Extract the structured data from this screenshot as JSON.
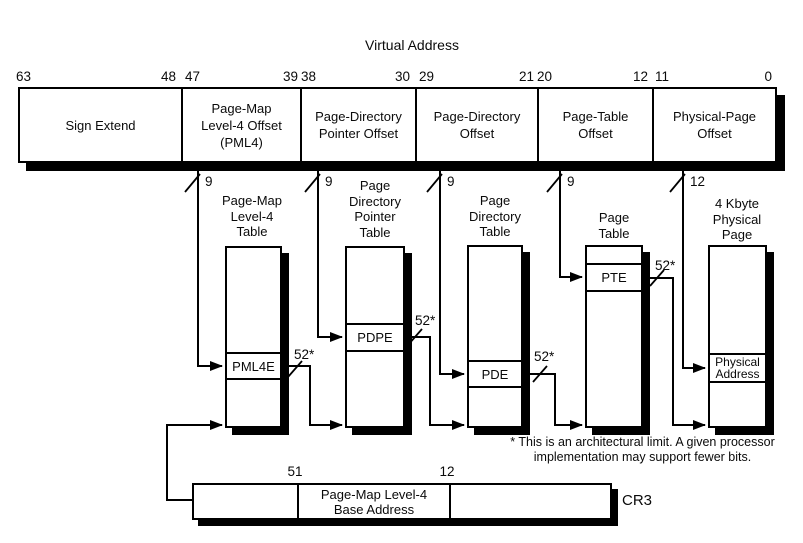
{
  "title": "Virtual Address",
  "va": {
    "bits": [
      "63",
      "48",
      "47",
      "39",
      "38",
      "30",
      "29",
      "21",
      "20",
      "12",
      "11",
      "0"
    ],
    "fields": [
      "Sign Extend",
      "Page-Map\nLevel-4 Offset\n(PML4)",
      "Page-Directory\nPointer Offset",
      "Page-Directory\nOffset",
      "Page-Table\nOffset",
      "Physical-Page\nOffset"
    ]
  },
  "widths": {
    "drops": [
      "9",
      "9",
      "9",
      "9",
      "12"
    ],
    "out": "52*"
  },
  "tables": [
    {
      "title": "Page-Map\nLevel-4\nTable",
      "entry": "PML4E"
    },
    {
      "title": "Page\nDirectory\nPointer\nTable",
      "entry": "PDPE"
    },
    {
      "title": "Page\nDirectory\nTable",
      "entry": "PDE"
    },
    {
      "title": "Page\nTable",
      "entry": "PTE"
    },
    {
      "title": "4 Kbyte\nPhysical\nPage",
      "entry": "Physical\nAddress"
    }
  ],
  "cr3": {
    "bits": [
      "51",
      "12"
    ],
    "field": "Page-Map Level-4\nBase Address",
    "label": "CR3"
  },
  "footnote": "* This is an architectural limit. A given processor\nimplementation may support fewer bits."
}
